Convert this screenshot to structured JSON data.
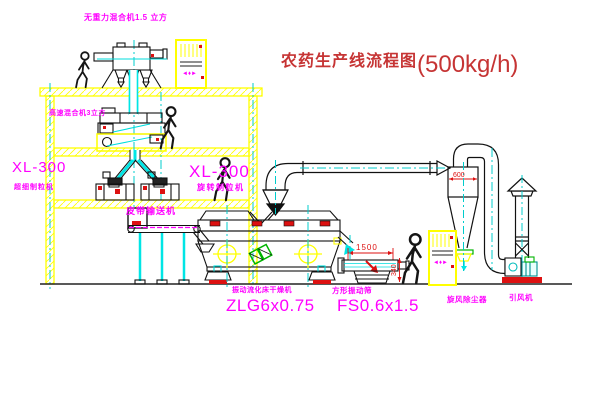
{
  "title": {
    "cn": "农药生产线流程图",
    "capacity": "(500kg/h)"
  },
  "labels": {
    "gravity_mixer": "无重力混合机1.5 立方",
    "speed_mixer": "高速混合机3立方",
    "xl_left_model": "XL-300",
    "xl_left_name": "超细制粒机",
    "xl_mid_model": "XL-300",
    "xl_mid_name": "旋转制粒机",
    "conveyor": "皮带输送机",
    "dryer_name": "振动流化床干燥机",
    "dryer_model": "ZLG6x0.75",
    "screen_name": "方形振动筛",
    "screen_model": "FS0.6x1.5",
    "cyclone": "旋风除尘器",
    "fan": "引风机"
  },
  "dimensions": {
    "screen_length": "1500",
    "screen_height": "340",
    "cyclone_diameter": "600"
  },
  "glyphs": {
    "cabinet": "◄♦►"
  },
  "colors": {
    "structure": "#ffff00",
    "centerline": "#00cccc",
    "label": "#ff00ff",
    "title": "#c63434",
    "dimension": "#dd1111",
    "accent_green": "#00b400"
  }
}
